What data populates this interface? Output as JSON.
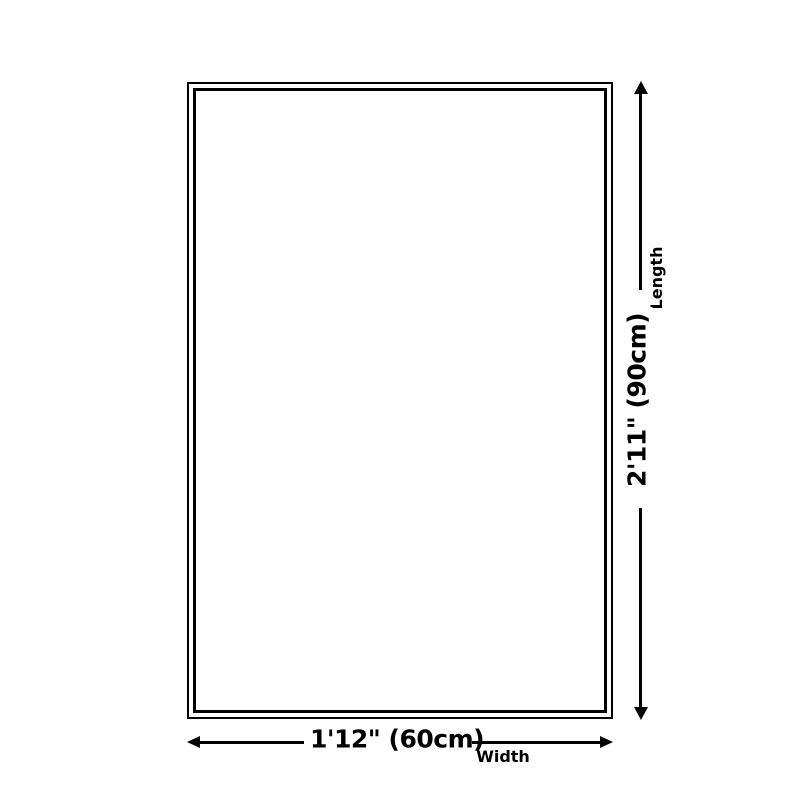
{
  "colors": {
    "line": "#000000",
    "background": "#ffffff"
  },
  "dimensions": {
    "length": {
      "label": "Length",
      "value": "2'11\" (90cm)"
    },
    "width": {
      "label": "Width",
      "value": "1'12\" (60cm)"
    }
  }
}
